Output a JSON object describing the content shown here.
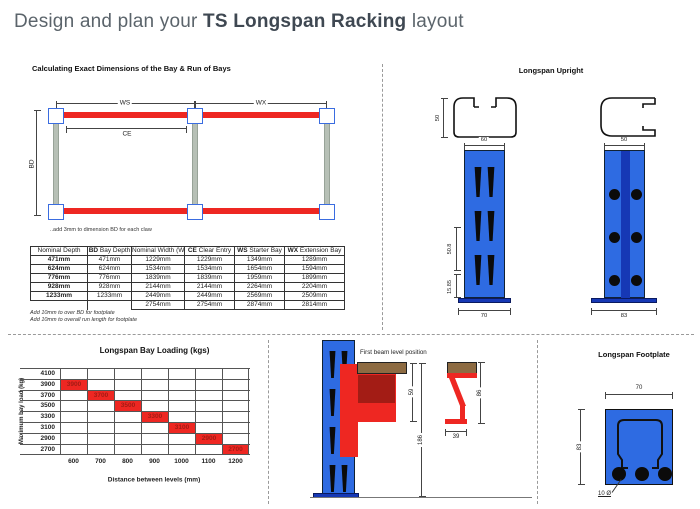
{
  "page": {
    "title_prefix": "Design and plan your ",
    "title_emphasis": "TS Longspan Racking",
    "title_suffix": " layout"
  },
  "bay_dimensions": {
    "heading": "Calculating Exact Dimensions of the Bay & Run of Bays",
    "dim_ws": "WS",
    "dim_wx": "WX",
    "dim_ce": "CE",
    "dim_bd": "BD",
    "claw_note": "..add 3mm to dimension BD for each claw",
    "table": {
      "headers": [
        {
          "bold": "",
          "text": "Nominal Depth"
        },
        {
          "bold": "BD",
          "text": " Bay Depth"
        },
        {
          "bold": "",
          "text": "Nominal Width (W)"
        },
        {
          "bold": "CE",
          "text": " Clear Entry"
        },
        {
          "bold": "WS",
          "text": " Starter Bay"
        },
        {
          "bold": "WX",
          "text": " Extension Bay"
        }
      ],
      "rows": [
        [
          "471mm",
          "471mm",
          "1229mm",
          "1229mm",
          "1349mm",
          "1289mm"
        ],
        [
          "624mm",
          "624mm",
          "1534mm",
          "1534mm",
          "1654mm",
          "1594mm"
        ],
        [
          "776mm",
          "776mm",
          "1839mm",
          "1839mm",
          "1959mm",
          "1899mm"
        ],
        [
          "928mm",
          "928mm",
          "2144mm",
          "2144mm",
          "2264mm",
          "2204mm"
        ],
        [
          "1233mm",
          "1233mm",
          "2449mm",
          "2449mm",
          "2569mm",
          "2509mm"
        ],
        [
          "",
          "",
          "2754mm",
          "2754mm",
          "2874mm",
          "2814mm"
        ]
      ]
    },
    "footnote_1": "Add 10mm to over BD for footplate",
    "footnote_2": "Add 10mm to overall run length for footplate"
  },
  "upright": {
    "heading": "Longspan Upright",
    "left_profile_height": "50",
    "left_width": "60",
    "left_pitch": "50.8",
    "left_bottom": "15.85",
    "left_base": "70",
    "right_width": "50",
    "right_base": "83"
  },
  "chart_data": {
    "type": "heatmap",
    "title": "Longspan Bay Loading (kgs)",
    "xlabel": "Distance between levels (mm)",
    "ylabel": "Maximum bay load (kg)",
    "x_ticks": [
      "600",
      "700",
      "800",
      "900",
      "1000",
      "1100",
      "1200"
    ],
    "y_ticks": [
      "4100",
      "3900",
      "3700",
      "3500",
      "3300",
      "3100",
      "2900",
      "2700"
    ],
    "cells": [
      {
        "x": "600",
        "y": "3900",
        "value": "3900"
      },
      {
        "x": "700",
        "y": "3700",
        "value": "3700"
      },
      {
        "x": "800",
        "y": "3500",
        "value": "3500"
      },
      {
        "x": "900",
        "y": "3300",
        "value": "3300"
      },
      {
        "x": "1000",
        "y": "3100",
        "value": "3100"
      },
      {
        "x": "1100",
        "y": "2900",
        "value": "2900"
      },
      {
        "x": "1200",
        "y": "2700",
        "value": "2700"
      }
    ],
    "grid": true,
    "legend": "none"
  },
  "first_beam": {
    "label": "First beam level position",
    "beam_face_dim": "59",
    "first_level_dim": "186",
    "profile_width_dim": "39",
    "profile_height_dim": "86"
  },
  "footplate": {
    "heading": "Longspan Footplate",
    "width_dim": "70",
    "height_dim": "83",
    "hole_label": "10 Ø"
  },
  "colors": {
    "blue": "#2e6be2",
    "dark_blue": "#1638b5",
    "red": "#ee2722",
    "dark_red": "#a31c15",
    "brown": "#8d6b42",
    "brace_grey": "#b7c0b6"
  }
}
